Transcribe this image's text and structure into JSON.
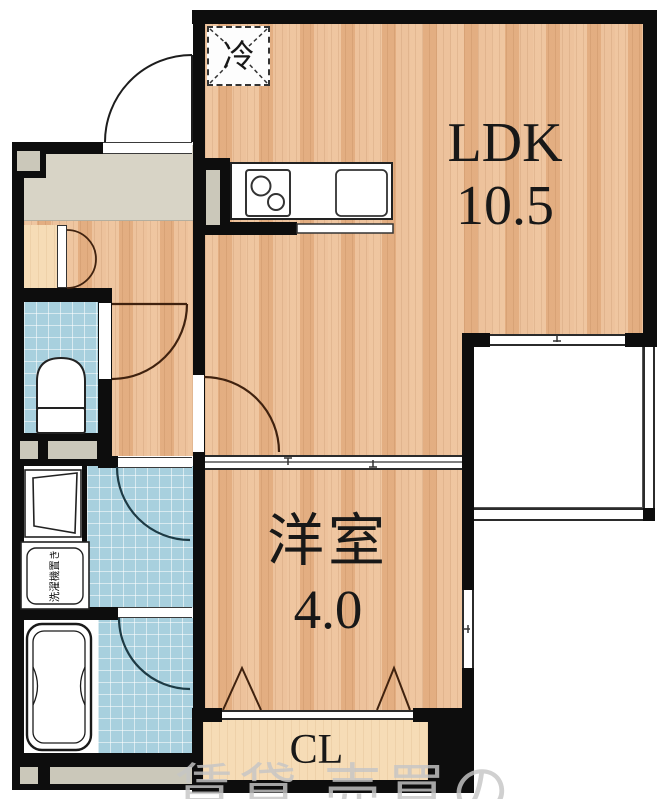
{
  "plan": {
    "type": "apartment-floor-plan",
    "rooms": {
      "ldk": {
        "label": "LDK",
        "size": "10.5"
      },
      "western_room": {
        "label": "洋室",
        "size": "4.0"
      },
      "closet": {
        "label": "CL"
      },
      "refrigerator_space": {
        "label": "冷"
      },
      "laundry_space": {
        "label": "洗濯機置き"
      }
    },
    "watermark": "賃貸 売買の",
    "fixtures": [
      "entrance-door",
      "shoe-cabinet-double-door",
      "toilet",
      "washbasin",
      "washing-machine-space",
      "bathtub",
      "kitchen-counter",
      "stove-burners",
      "kitchen-sink",
      "refrigerator-space",
      "balcony",
      "sliding-partition",
      "bifold-closet-doors",
      "side-window",
      "balcony-window"
    ],
    "colors": {
      "wall": "#0d0d0d",
      "wood_floor": "#e9b78c",
      "tile_blue": "#a8d0de",
      "entrance_gray": "#d8d4c6",
      "closet_tan": "#f6dcb6",
      "door_arc_brown": "#40220f",
      "watermark_gray": "#c6c6c6"
    }
  }
}
